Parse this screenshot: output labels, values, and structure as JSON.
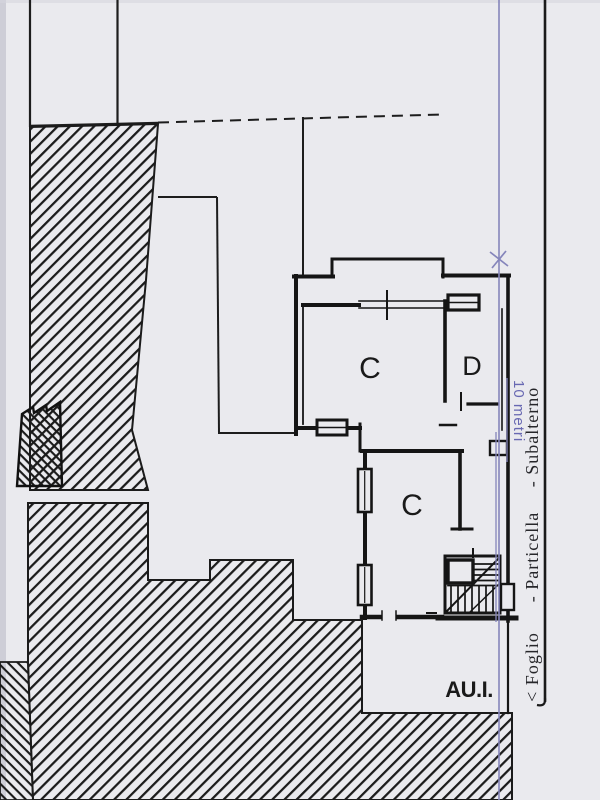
{
  "plan": {
    "room_labels": {
      "upper_left": "C",
      "upper_right": "D",
      "middle": "C",
      "courtyard": "AU.I."
    },
    "scale_label": "10 metri",
    "caption_labels": {
      "foglio": "< Foglio",
      "particella": "- Particella",
      "subalterno": "- Subalterno"
    },
    "colors": {
      "paper": "#eaeaee",
      "ink": "#1a1a1a",
      "scale_line": "#8585bb",
      "scale_text": "#6868b2",
      "caption_ink": "#26262a"
    }
  }
}
